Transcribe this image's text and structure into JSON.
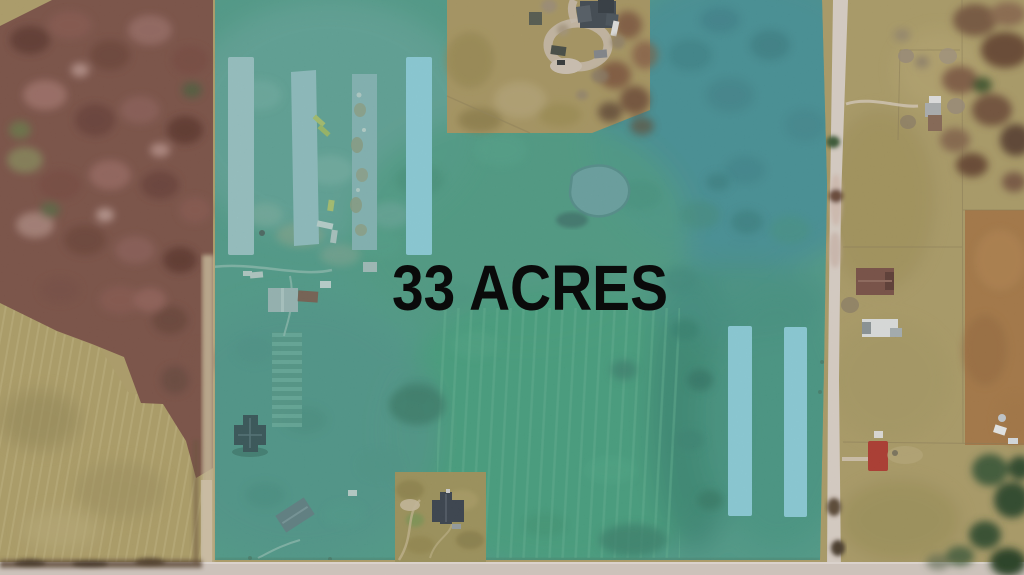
{
  "listing": {
    "acreage_label": "33 ACRES"
  },
  "colors": {
    "parcel_overlay": "#2E9B8C",
    "building_highlight": "#8ED2DE",
    "label_text": "#0A0A0A"
  }
}
